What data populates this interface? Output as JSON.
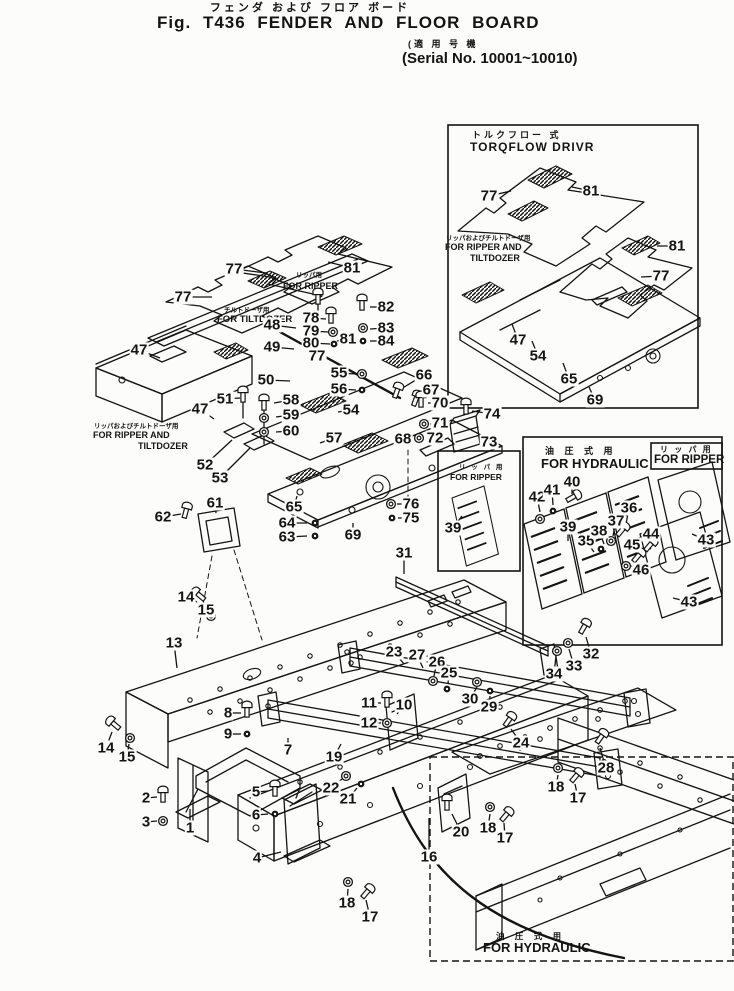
{
  "colors": {
    "ink": "#141414",
    "paper": "#fcfcfa"
  },
  "title": {
    "furigana": "フェンダ および フロア ボード",
    "fig": "Fig. T436 FENDER AND FLOOR BOARD",
    "serial_jp": "(適 用 号 機",
    "serial_en": "(Serial No. 10001~10010)"
  },
  "boxes": {
    "torqflow": {
      "jp": "トルクフロー 式",
      "en": "TORQFLOW DRIVR",
      "note_jp": "リッパおよびチルトドーザ用",
      "note_en1": "FOR RIPPER AND",
      "note_en2": "TILTDOZER"
    },
    "hydraulic": {
      "jp": "油 圧 式 用",
      "en": "FOR HYDRAULIC"
    },
    "hydraulic_ripper": {
      "jp": "リ ッ パ 用",
      "en": "FOR RIPPER"
    },
    "left_panel": {
      "jp": "リ ッ パ 用",
      "en": "FOR RIPPER"
    },
    "bottom": {
      "jp": "油 圧 式 用",
      "en": "FOR HYDRAULIC"
    }
  },
  "notes": {
    "ripper_top": {
      "jp": "リッパ用",
      "en": "FOR RIPPER"
    },
    "tiltdozer": {
      "jp": "チルトドーザ用",
      "en": "FOR TILTDOZER"
    },
    "left": {
      "jp": "リッパおよびチルトドーザ用",
      "en1": "FOR RIPPER AND",
      "en2": "TILTDOZER"
    }
  },
  "callouts": [
    {
      "t": "77",
      "x": 234,
      "y": 269,
      "lx": 266,
      "ly": 273
    },
    {
      "t": "81",
      "x": 352,
      "y": 268,
      "lx": 328,
      "ly": 262
    },
    {
      "t": "77",
      "x": 183,
      "y": 297,
      "lx": 212,
      "ly": 297
    },
    {
      "t": "47",
      "x": 139,
      "y": 350,
      "lx": 160,
      "ly": 358
    },
    {
      "t": "48",
      "x": 272,
      "y": 325,
      "lx": 296,
      "ly": 328
    },
    {
      "t": "49",
      "x": 272,
      "y": 347,
      "lx": 294,
      "ly": 349
    },
    {
      "t": "50",
      "x": 266,
      "y": 380,
      "lx": 290,
      "ly": 381
    },
    {
      "t": "51",
      "x": 225,
      "y": 399,
      "lx": 240,
      "ly": 398
    },
    {
      "t": "47",
      "x": 200,
      "y": 409,
      "lx": 214,
      "ly": 419
    },
    {
      "t": "52",
      "x": 205,
      "y": 465,
      "lx": 232,
      "ly": 440
    },
    {
      "t": "53",
      "x": 220,
      "y": 478,
      "lx": 250,
      "ly": 448
    },
    {
      "t": "61",
      "x": 215,
      "y": 503,
      "lx": 216,
      "ly": 513
    },
    {
      "t": "62",
      "x": 163,
      "y": 517,
      "lx": 181,
      "ly": 514
    },
    {
      "t": "78",
      "x": 311,
      "y": 318,
      "lx": 326,
      "ly": 319
    },
    {
      "t": "79",
      "x": 311,
      "y": 331,
      "lx": 328,
      "ly": 332
    },
    {
      "t": "80",
      "x": 311,
      "y": 343,
      "lx": 330,
      "ly": 344
    },
    {
      "t": "81",
      "x": 348,
      "y": 339,
      "lx": 337,
      "ly": 341
    },
    {
      "t": "77",
      "x": 317,
      "y": 356,
      "lx": 323,
      "ly": 349
    },
    {
      "t": "82",
      "x": 386,
      "y": 307,
      "lx": 370,
      "ly": 307
    },
    {
      "t": "83",
      "x": 386,
      "y": 328,
      "lx": 370,
      "ly": 329
    },
    {
      "t": "84",
      "x": 386,
      "y": 341,
      "lx": 370,
      "ly": 341
    },
    {
      "t": "55",
      "x": 339,
      "y": 373,
      "lx": 356,
      "ly": 374
    },
    {
      "t": "56",
      "x": 339,
      "y": 389,
      "lx": 356,
      "ly": 390
    },
    {
      "t": "58",
      "x": 291,
      "y": 400,
      "lx": 274,
      "ly": 403
    },
    {
      "t": "59",
      "x": 291,
      "y": 415,
      "lx": 276,
      "ly": 417
    },
    {
      "t": "60",
      "x": 291,
      "y": 431,
      "lx": 276,
      "ly": 432
    },
    {
      "t": "54",
      "x": 351,
      "y": 410,
      "lx": 338,
      "ly": 412
    },
    {
      "t": "57",
      "x": 334,
      "y": 438,
      "lx": 320,
      "ly": 443
    },
    {
      "t": "64",
      "x": 287,
      "y": 523,
      "lx": 307,
      "ly": 523
    },
    {
      "t": "63",
      "x": 287,
      "y": 537,
      "lx": 307,
      "ly": 536
    },
    {
      "t": "65",
      "x": 294,
      "y": 507,
      "lx": 297,
      "ly": 496
    },
    {
      "t": "69",
      "x": 353,
      "y": 535,
      "lx": 353,
      "ly": 523
    },
    {
      "t": "66",
      "x": 424,
      "y": 375,
      "lx": 401,
      "ly": 389
    },
    {
      "t": "67",
      "x": 431,
      "y": 390,
      "lx": 418,
      "ly": 397
    },
    {
      "t": "70",
      "x": 440,
      "y": 403,
      "lx": 428,
      "ly": 403
    },
    {
      "t": "71",
      "x": 440,
      "y": 423,
      "lx": 430,
      "ly": 424
    },
    {
      "t": "72",
      "x": 435,
      "y": 438,
      "lx": 426,
      "ly": 438
    },
    {
      "t": "68",
      "x": 403,
      "y": 439,
      "lx": 411,
      "ly": 440
    },
    {
      "t": "74",
      "x": 492,
      "y": 414,
      "lx": 472,
      "ly": 411
    },
    {
      "t": "73",
      "x": 489,
      "y": 442,
      "lx": 479,
      "ly": 442
    },
    {
      "t": "76",
      "x": 411,
      "y": 504,
      "lx": 397,
      "ly": 504
    },
    {
      "t": "75",
      "x": 411,
      "y": 518,
      "lx": 398,
      "ly": 518
    },
    {
      "t": "31",
      "x": 404,
      "y": 553,
      "lx": 404,
      "ly": 574
    },
    {
      "t": "77",
      "x": 489,
      "y": 196,
      "lx": 511,
      "ly": 191
    },
    {
      "t": "81",
      "x": 591,
      "y": 191,
      "lx": 572,
      "ly": 187
    },
    {
      "t": "81",
      "x": 677,
      "y": 246,
      "lx": 657,
      "ly": 246
    },
    {
      "t": "77",
      "x": 661,
      "y": 276,
      "lx": 641,
      "ly": 277
    },
    {
      "t": "47",
      "x": 518,
      "y": 340,
      "lx": 512,
      "ly": 324
    },
    {
      "t": "54",
      "x": 538,
      "y": 356,
      "lx": 532,
      "ly": 341
    },
    {
      "t": "65",
      "x": 569,
      "y": 379,
      "lx": 563,
      "ly": 363
    },
    {
      "t": "69",
      "x": 595,
      "y": 400,
      "lx": 589,
      "ly": 387
    },
    {
      "t": "42",
      "x": 537,
      "y": 497,
      "lx": 540,
      "ly": 512
    },
    {
      "t": "41",
      "x": 552,
      "y": 490,
      "lx": 553,
      "ly": 505
    },
    {
      "t": "40",
      "x": 572,
      "y": 482,
      "lx": 572,
      "ly": 494
    },
    {
      "t": "39",
      "x": 453,
      "y": 528,
      "lx": 462,
      "ly": 516
    },
    {
      "t": "39",
      "x": 568,
      "y": 527,
      "lx": 568,
      "ly": 541
    },
    {
      "t": "35",
      "x": 586,
      "y": 541,
      "lx": 594,
      "ly": 552
    },
    {
      "t": "38",
      "x": 599,
      "y": 531,
      "lx": 604,
      "ly": 544
    },
    {
      "t": "37",
      "x": 616,
      "y": 521,
      "lx": 613,
      "ly": 536
    },
    {
      "t": "36",
      "x": 629,
      "y": 508,
      "lx": 626,
      "ly": 524
    },
    {
      "t": "44",
      "x": 651,
      "y": 534,
      "lx": 650,
      "ly": 542
    },
    {
      "t": "45",
      "x": 632,
      "y": 545,
      "lx": 636,
      "ly": 553
    },
    {
      "t": "46",
      "x": 641,
      "y": 570,
      "lx": 631,
      "ly": 566
    },
    {
      "t": "43",
      "x": 706,
      "y": 540,
      "lx": 692,
      "ly": 534
    },
    {
      "t": "43",
      "x": 689,
      "y": 602,
      "lx": 673,
      "ly": 598
    },
    {
      "t": "14",
      "x": 186,
      "y": 597,
      "lx": 197,
      "ly": 602
    },
    {
      "t": "15",
      "x": 206,
      "y": 610,
      "lx": 210,
      "ly": 616
    },
    {
      "t": "13",
      "x": 174,
      "y": 643,
      "lx": 177,
      "ly": 668
    },
    {
      "t": "23",
      "x": 394,
      "y": 652,
      "lx": 404,
      "ly": 664
    },
    {
      "t": "27",
      "x": 417,
      "y": 655,
      "lx": 423,
      "ly": 668
    },
    {
      "t": "26",
      "x": 437,
      "y": 662,
      "lx": 434,
      "ly": 676
    },
    {
      "t": "25",
      "x": 449,
      "y": 673,
      "lx": 448,
      "ly": 684
    },
    {
      "t": "30",
      "x": 470,
      "y": 699,
      "lx": 477,
      "ly": 687
    },
    {
      "t": "29",
      "x": 489,
      "y": 707,
      "lx": 490,
      "ly": 696
    },
    {
      "t": "34",
      "x": 554,
      "y": 674,
      "lx": 556,
      "ly": 656
    },
    {
      "t": "33",
      "x": 574,
      "y": 666,
      "lx": 569,
      "ly": 649
    },
    {
      "t": "32",
      "x": 591,
      "y": 654,
      "lx": 586,
      "ly": 637
    },
    {
      "t": "11",
      "x": 369,
      "y": 703,
      "lx": 381,
      "ly": 703
    },
    {
      "t": "12",
      "x": 369,
      "y": 723,
      "lx": 381,
      "ly": 723
    },
    {
      "t": "10",
      "x": 404,
      "y": 705,
      "lx": 397,
      "ly": 714
    },
    {
      "t": "8",
      "x": 228,
      "y": 713,
      "lx": 241,
      "ly": 713
    },
    {
      "t": "9",
      "x": 228,
      "y": 734,
      "lx": 241,
      "ly": 734
    },
    {
      "t": "7",
      "x": 288,
      "y": 750,
      "lx": 288,
      "ly": 738
    },
    {
      "t": "19",
      "x": 334,
      "y": 757,
      "lx": 341,
      "ly": 744
    },
    {
      "t": "22",
      "x": 331,
      "y": 788,
      "lx": 342,
      "ly": 779
    },
    {
      "t": "21",
      "x": 348,
      "y": 799,
      "lx": 357,
      "ly": 788
    },
    {
      "t": "2",
      "x": 146,
      "y": 798,
      "lx": 157,
      "ly": 797
    },
    {
      "t": "3",
      "x": 146,
      "y": 822,
      "lx": 157,
      "ly": 821
    },
    {
      "t": "1",
      "x": 190,
      "y": 828,
      "lx": 190,
      "ly": 809
    },
    {
      "t": "5",
      "x": 256,
      "y": 792,
      "lx": 268,
      "ly": 791
    },
    {
      "t": "6",
      "x": 256,
      "y": 815,
      "lx": 268,
      "ly": 814
    },
    {
      "t": "4",
      "x": 257,
      "y": 858,
      "lx": 281,
      "ly": 852
    },
    {
      "t": "24",
      "x": 521,
      "y": 743,
      "lx": 511,
      "ly": 729
    },
    {
      "t": "16",
      "x": 429,
      "y": 857,
      "lx": 429,
      "ly": 818
    },
    {
      "t": "20",
      "x": 461,
      "y": 832,
      "lx": 452,
      "ly": 814
    },
    {
      "t": "28",
      "x": 606,
      "y": 768,
      "lx": 600,
      "ly": 748
    },
    {
      "t": "18",
      "x": 556,
      "y": 787,
      "lx": 558,
      "ly": 775
    },
    {
      "t": "17",
      "x": 578,
      "y": 798,
      "lx": 575,
      "ly": 784
    },
    {
      "t": "18",
      "x": 488,
      "y": 828,
      "lx": 490,
      "ly": 814
    },
    {
      "t": "17",
      "x": 505,
      "y": 838,
      "lx": 504,
      "ly": 823
    },
    {
      "t": "18",
      "x": 347,
      "y": 903,
      "lx": 348,
      "ly": 889
    },
    {
      "t": "17",
      "x": 370,
      "y": 917,
      "lx": 366,
      "ly": 900
    },
    {
      "t": "14",
      "x": 106,
      "y": 748,
      "lx": 112,
      "ly": 732
    },
    {
      "t": "15",
      "x": 127,
      "y": 757,
      "lx": 129,
      "ly": 744
    }
  ],
  "fasteners": [
    [
      "bolt",
      331,
      316,
      0
    ],
    [
      "washer",
      333,
      332,
      0
    ],
    [
      "nut",
      334,
      344,
      0
    ],
    [
      "bolt",
      362,
      303,
      0
    ],
    [
      "washer",
      363,
      328,
      0
    ],
    [
      "nut",
      363,
      341,
      0
    ],
    [
      "bolt",
      318,
      297,
      0
    ],
    [
      "bolt",
      243,
      395,
      0
    ],
    [
      "bolt",
      264,
      403,
      0
    ],
    [
      "washer",
      264,
      418,
      0
    ],
    [
      "washer",
      264,
      432,
      0
    ],
    [
      "washer",
      362,
      374,
      0
    ],
    [
      "nut",
      362,
      390,
      0
    ],
    [
      "bolt",
      397,
      391,
      20
    ],
    [
      "bolt",
      416,
      399,
      20
    ],
    [
      "bolt",
      421,
      400,
      0
    ],
    [
      "washer",
      424,
      424,
      0
    ],
    [
      "washer",
      419,
      438,
      0
    ],
    [
      "bolt",
      466,
      407,
      0
    ],
    [
      "bolt",
      186,
      511,
      15
    ],
    [
      "nut",
      315,
      523,
      0
    ],
    [
      "nut",
      315,
      536,
      0
    ],
    [
      "washer",
      391,
      504,
      0
    ],
    [
      "nut",
      392,
      518,
      0
    ],
    [
      "bolt",
      199,
      595,
      -50
    ],
    [
      "washer",
      211,
      616,
      0
    ],
    [
      "bolt",
      114,
      724,
      -50
    ],
    [
      "washer",
      130,
      738,
      0
    ],
    [
      "bolt",
      247,
      710,
      0
    ],
    [
      "nut",
      247,
      734,
      0
    ],
    [
      "bolt",
      387,
      700,
      0
    ],
    [
      "washer",
      387,
      723,
      0
    ],
    [
      "bolt",
      163,
      795,
      0
    ],
    [
      "washer",
      163,
      821,
      0
    ],
    [
      "bolt",
      275,
      789,
      0
    ],
    [
      "nut",
      275,
      814,
      0
    ],
    [
      "washer",
      346,
      776,
      0
    ],
    [
      "nut",
      361,
      784,
      0
    ],
    [
      "washer",
      433,
      681,
      0
    ],
    [
      "nut",
      447,
      689,
      0
    ],
    [
      "washer",
      477,
      682,
      0
    ],
    [
      "nut",
      490,
      691,
      0
    ],
    [
      "bolt",
      584,
      627,
      30
    ],
    [
      "washer",
      568,
      643,
      0
    ],
    [
      "washer",
      557,
      651,
      0
    ],
    [
      "bolt",
      509,
      720,
      35
    ],
    [
      "bolt",
      601,
      737,
      35
    ],
    [
      "washer",
      558,
      768,
      0
    ],
    [
      "bolt",
      576,
      776,
      40
    ],
    [
      "washer",
      490,
      807,
      0
    ],
    [
      "bolt",
      506,
      815,
      40
    ],
    [
      "washer",
      348,
      882,
      0
    ],
    [
      "bolt",
      367,
      892,
      40
    ],
    [
      "bolt",
      447,
      803,
      0
    ],
    [
      "bolt",
      573,
      497,
      60
    ],
    [
      "nut",
      553,
      511,
      0
    ],
    [
      "washer",
      540,
      519,
      0
    ],
    [
      "bolt",
      622,
      530,
      40
    ],
    [
      "washer",
      611,
      541,
      0
    ],
    [
      "nut",
      601,
      549,
      0
    ],
    [
      "bolt",
      650,
      545,
      40
    ],
    [
      "bolt",
      638,
      556,
      40
    ],
    [
      "washer",
      626,
      566,
      0
    ]
  ]
}
